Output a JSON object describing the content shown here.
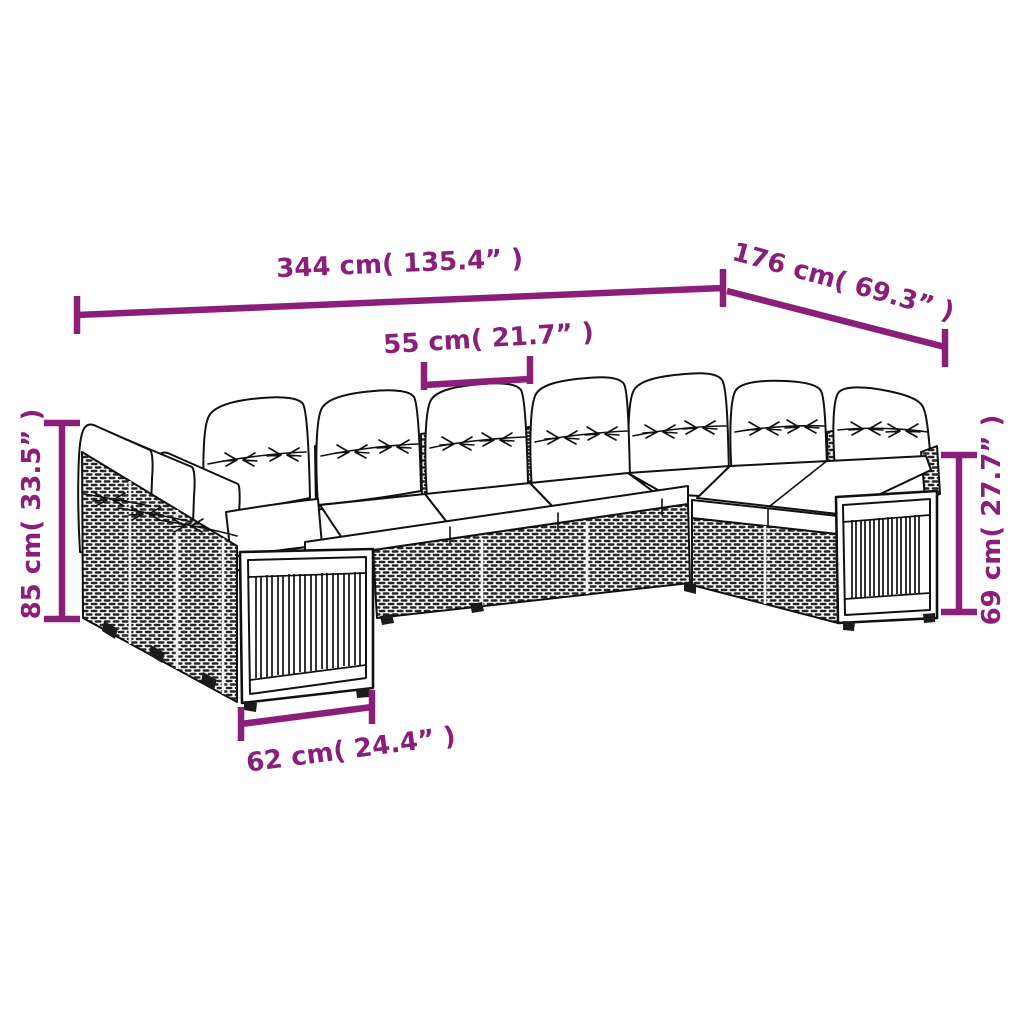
{
  "diagram": {
    "background": "#ffffff",
    "accent_color": "#8B1E78",
    "line_color": "#111111",
    "cushion_color": "#ffffff",
    "labels": {
      "total_width": "344 cm( 135.4” )",
      "total_depth": "176 cm( 69.3” )",
      "seat_width": "55 cm( 21.7” )",
      "back_height": "85 cm( 33.5” )",
      "arm_height": "69 cm( 27.7” )",
      "left_end_width": "62 cm( 24.4” )"
    }
  }
}
